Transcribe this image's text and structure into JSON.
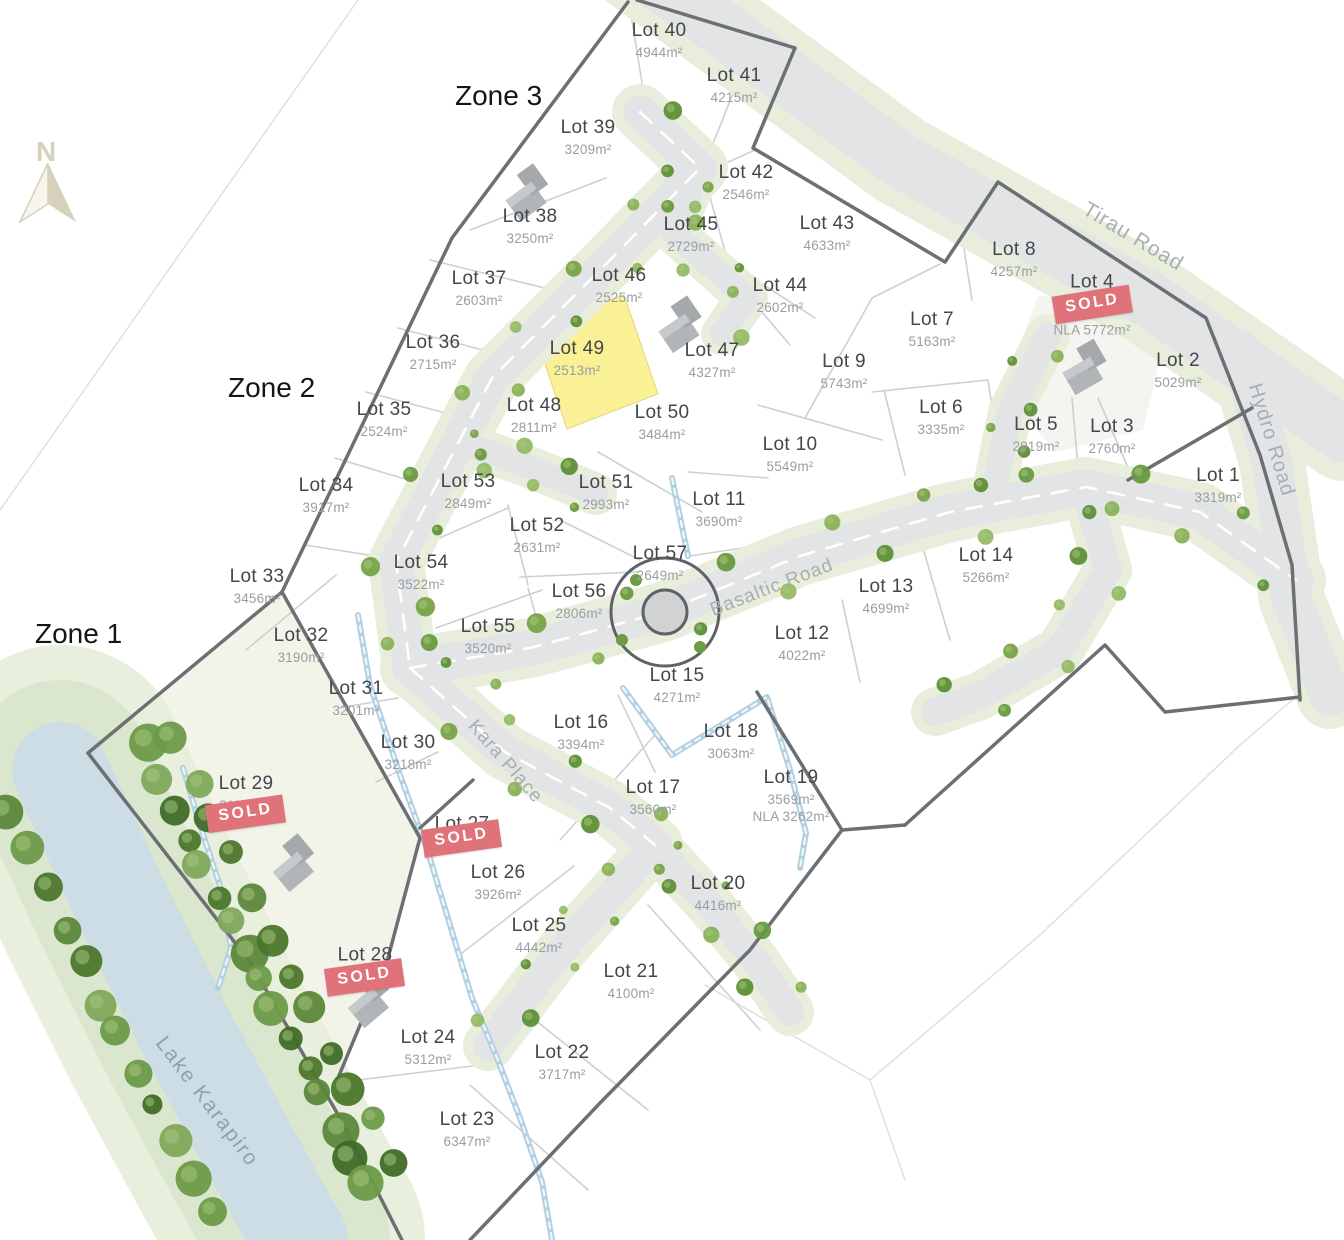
{
  "map": {
    "compass_label": "N",
    "water_label": "Lake Karapiro",
    "sold_badge_label": "SOLD",
    "zones": [
      {
        "label": "Zone 1"
      },
      {
        "label": "Zone 2"
      },
      {
        "label": "Zone 3"
      }
    ],
    "roads": [
      {
        "label": "Tirau Road"
      },
      {
        "label": "Hydro Road"
      },
      {
        "label": "Basaltic Road"
      },
      {
        "label": "Kara Place"
      }
    ],
    "colors": {
      "highlight_lot": "#FAF096",
      "sold_badge": "#E0737A",
      "road_surface": "#E2E4E6",
      "road_verge": "#E8EEDB",
      "water": "#CCDDE5"
    },
    "lots": [
      {
        "id": 1,
        "label": "Lot 1",
        "area": "3319m²"
      },
      {
        "id": 2,
        "label": "Lot 2",
        "area": "5029m²"
      },
      {
        "id": 3,
        "label": "Lot 3",
        "area": "2760m²"
      },
      {
        "id": 4,
        "label": "Lot 4",
        "area": "",
        "nla": "NLA 5772m²",
        "sold": true
      },
      {
        "id": 5,
        "label": "Lot 5",
        "area": "2919m²"
      },
      {
        "id": 6,
        "label": "Lot 6",
        "area": "3335m²"
      },
      {
        "id": 7,
        "label": "Lot 7",
        "area": "5163m²"
      },
      {
        "id": 8,
        "label": "Lot 8",
        "area": "4257m²"
      },
      {
        "id": 9,
        "label": "Lot 9",
        "area": "5743m²"
      },
      {
        "id": 10,
        "label": "Lot 10",
        "area": "5549m²"
      },
      {
        "id": 11,
        "label": "Lot 11",
        "area": "3690m²"
      },
      {
        "id": 12,
        "label": "Lot 12",
        "area": "4022m²"
      },
      {
        "id": 13,
        "label": "Lot 13",
        "area": "4699m²"
      },
      {
        "id": 14,
        "label": "Lot 14",
        "area": "5266m²"
      },
      {
        "id": 15,
        "label": "Lot 15",
        "area": "4271m²"
      },
      {
        "id": 16,
        "label": "Lot 16",
        "area": "3394m²"
      },
      {
        "id": 17,
        "label": "Lot 17",
        "area": "3560m²"
      },
      {
        "id": 18,
        "label": "Lot 18",
        "area": "3063m²"
      },
      {
        "id": 19,
        "label": "Lot 19",
        "area": "3569m²",
        "nla": "NLA 3262m²"
      },
      {
        "id": 20,
        "label": "Lot 20",
        "area": "4416m²"
      },
      {
        "id": 21,
        "label": "Lot 21",
        "area": "4100m²"
      },
      {
        "id": 22,
        "label": "Lot 22",
        "area": "3717m²"
      },
      {
        "id": 23,
        "label": "Lot 23",
        "area": "6347m²"
      },
      {
        "id": 24,
        "label": "Lot 24",
        "area": "5312m²"
      },
      {
        "id": 25,
        "label": "Lot 25",
        "area": "4442m²"
      },
      {
        "id": 26,
        "label": "Lot 26",
        "area": "3926m²"
      },
      {
        "id": 27,
        "label": "Lot 27",
        "area": "",
        "sold": true
      },
      {
        "id": 28,
        "label": "Lot 28",
        "area": "",
        "sold": true
      },
      {
        "id": 29,
        "label": "Lot 29",
        "area": "21190m²",
        "sold": true
      },
      {
        "id": 30,
        "label": "Lot 30",
        "area": "3218m²"
      },
      {
        "id": 31,
        "label": "Lot 31",
        "area": "3201m²"
      },
      {
        "id": 32,
        "label": "Lot 32",
        "area": "3190m²"
      },
      {
        "id": 33,
        "label": "Lot 33",
        "area": "3456m²"
      },
      {
        "id": 34,
        "label": "Lot 34",
        "area": "3917m²"
      },
      {
        "id": 35,
        "label": "Lot 35",
        "area": "2524m²"
      },
      {
        "id": 36,
        "label": "Lot 36",
        "area": "2715m²"
      },
      {
        "id": 37,
        "label": "Lot 37",
        "area": "2603m²"
      },
      {
        "id": 38,
        "label": "Lot 38",
        "area": "3250m²"
      },
      {
        "id": 39,
        "label": "Lot 39",
        "area": "3209m²"
      },
      {
        "id": 40,
        "label": "Lot 40",
        "area": "4944m²"
      },
      {
        "id": 41,
        "label": "Lot 41",
        "area": "4215m²"
      },
      {
        "id": 42,
        "label": "Lot 42",
        "area": "2546m²"
      },
      {
        "id": 43,
        "label": "Lot 43",
        "area": "4633m²"
      },
      {
        "id": 44,
        "label": "Lot 44",
        "area": "2602m²"
      },
      {
        "id": 45,
        "label": "Lot 45",
        "area": "2729m²"
      },
      {
        "id": 46,
        "label": "Lot 46",
        "area": "2525m²"
      },
      {
        "id": 47,
        "label": "Lot 47",
        "area": "4327m²"
      },
      {
        "id": 48,
        "label": "Lot 48",
        "area": "2811m²"
      },
      {
        "id": 49,
        "label": "Lot 49",
        "area": "2513m²",
        "highlighted": true
      },
      {
        "id": 50,
        "label": "Lot 50",
        "area": "3484m²"
      },
      {
        "id": 51,
        "label": "Lot 51",
        "area": "2993m²"
      },
      {
        "id": 52,
        "label": "Lot 52",
        "area": "2631m²"
      },
      {
        "id": 53,
        "label": "Lot 53",
        "area": "2849m²"
      },
      {
        "id": 54,
        "label": "Lot 54",
        "area": "3522m²"
      },
      {
        "id": 55,
        "label": "Lot 55",
        "area": "3520m²"
      },
      {
        "id": 56,
        "label": "Lot 56",
        "area": "2806m²"
      },
      {
        "id": 57,
        "label": "Lot 57",
        "area": "2649m²"
      }
    ]
  }
}
